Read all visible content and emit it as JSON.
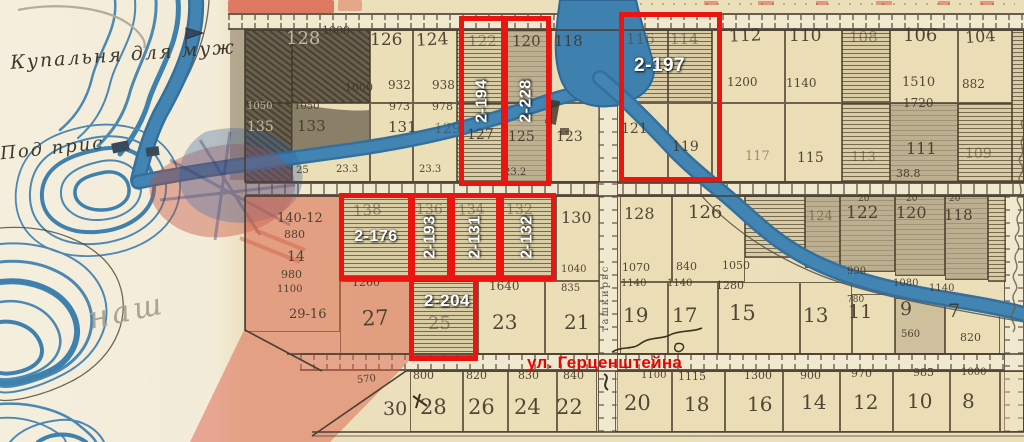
{
  "colors": {
    "paper": "#f0e7cd",
    "grid_ink": "#4a4034",
    "water": "#3f81ae",
    "water_deep": "#2c6693",
    "wash_red": "#d95f4a",
    "annotation_red": "#ea1410",
    "label_white": "#ffffff",
    "street_red": "#e30505",
    "pencil": "#aba393",
    "dark_plot": "#6a604d"
  },
  "annotations": {
    "street_label": "ул. Герценштейна",
    "boxes": [
      {
        "id": "2-194",
        "x": 459,
        "y": 16,
        "w": 47,
        "h": 170,
        "style": "vert"
      },
      {
        "id": "2-228",
        "x": 503,
        "y": 16,
        "w": 48,
        "h": 170,
        "style": "vert"
      },
      {
        "id": "2-197",
        "x": 619,
        "y": 12,
        "w": 103,
        "h": 170,
        "style": "corner"
      },
      {
        "id": "2-176",
        "x": 339,
        "y": 193,
        "w": 74,
        "h": 88,
        "style": "mid"
      },
      {
        "id": "2-193",
        "x": 410,
        "y": 193,
        "w": 42,
        "h": 88,
        "style": "vert"
      },
      {
        "id": "2-131",
        "x": 450,
        "y": 193,
        "w": 51,
        "h": 88,
        "style": "vert"
      },
      {
        "id": "2-132",
        "x": 499,
        "y": 193,
        "w": 57,
        "h": 88,
        "style": "vert"
      },
      {
        "id": "2-204",
        "x": 409,
        "y": 276,
        "w": 69,
        "h": 85,
        "style": "top"
      }
    ]
  },
  "handwriting": {
    "note_bath": "Купальня для муж",
    "note_pier": "Под прис",
    "pencil_note": "наш",
    "street_vertical": "ташкирвс"
  },
  "map": {
    "cells": [
      [
        245,
        30,
        47,
        73,
        "dark"
      ],
      [
        292,
        30,
        78,
        73,
        "dark"
      ],
      [
        370,
        30,
        43,
        73,
        "plain"
      ],
      [
        413,
        30,
        44,
        73,
        "plain"
      ],
      [
        457,
        30,
        48,
        73,
        "hatch"
      ],
      [
        505,
        30,
        46,
        73,
        "gray"
      ],
      [
        551,
        30,
        49,
        73,
        "plain"
      ],
      [
        245,
        103,
        47,
        79,
        "dark"
      ],
      [
        292,
        103,
        78,
        79,
        "plain"
      ],
      [
        370,
        103,
        43,
        79,
        "plain"
      ],
      [
        413,
        103,
        44,
        79,
        "plain"
      ],
      [
        457,
        103,
        48,
        79,
        "hatch"
      ],
      [
        505,
        103,
        46,
        79,
        "gray"
      ],
      [
        551,
        103,
        49,
        79,
        "plain"
      ],
      [
        620,
        30,
        48,
        73,
        "hatch"
      ],
      [
        668,
        30,
        44,
        73,
        "hatch"
      ],
      [
        712,
        30,
        73,
        73,
        "plain"
      ],
      [
        785,
        30,
        57,
        73,
        "plain"
      ],
      [
        842,
        30,
        48,
        73,
        "hatch"
      ],
      [
        890,
        30,
        68,
        73,
        "plain"
      ],
      [
        958,
        30,
        54,
        73,
        "plain"
      ],
      [
        1012,
        30,
        12,
        152,
        "hatch"
      ],
      [
        620,
        103,
        48,
        79,
        "plain"
      ],
      [
        668,
        103,
        44,
        79,
        "plain"
      ],
      [
        712,
        103,
        73,
        79,
        "plain"
      ],
      [
        785,
        103,
        57,
        79,
        "plain"
      ],
      [
        842,
        103,
        48,
        79,
        "hatch"
      ],
      [
        890,
        103,
        68,
        79,
        "gray"
      ],
      [
        958,
        103,
        54,
        79,
        "hatch"
      ],
      [
        245,
        196,
        95,
        136,
        "plain"
      ],
      [
        340,
        196,
        72,
        85,
        "hatch"
      ],
      [
        412,
        196,
        40,
        85,
        "hatch"
      ],
      [
        452,
        196,
        51,
        85,
        "hatch"
      ],
      [
        503,
        196,
        53,
        85,
        "hatch"
      ],
      [
        556,
        196,
        44,
        85,
        "plain"
      ],
      [
        340,
        281,
        72,
        73,
        "plain"
      ],
      [
        412,
        281,
        66,
        80,
        "hatch"
      ],
      [
        478,
        281,
        67,
        73,
        "plain"
      ],
      [
        545,
        281,
        55,
        73,
        "plain"
      ],
      [
        620,
        196,
        52,
        86,
        "plain"
      ],
      [
        672,
        196,
        73,
        86,
        "plain"
      ],
      [
        745,
        196,
        60,
        62,
        "hatch"
      ],
      [
        805,
        196,
        35,
        72,
        "gray"
      ],
      [
        840,
        196,
        55,
        76,
        "gray"
      ],
      [
        895,
        196,
        50,
        80,
        "gray"
      ],
      [
        945,
        196,
        43,
        84,
        "gray"
      ],
      [
        988,
        196,
        18,
        86,
        "hatch"
      ],
      [
        620,
        282,
        48,
        72,
        "plain"
      ],
      [
        668,
        282,
        50,
        72,
        "plain"
      ],
      [
        718,
        282,
        82,
        72,
        "plain"
      ],
      [
        800,
        282,
        52,
        72,
        "plain"
      ],
      [
        852,
        294,
        43,
        60,
        "plain"
      ],
      [
        895,
        298,
        50,
        56,
        "tan"
      ],
      [
        945,
        303,
        55,
        51,
        "plain"
      ],
      [
        410,
        371,
        53,
        61,
        "plain"
      ],
      [
        463,
        371,
        45,
        61,
        "plain"
      ],
      [
        508,
        371,
        49,
        61,
        "plain"
      ],
      [
        557,
        371,
        40,
        61,
        "plain"
      ],
      [
        615,
        371,
        57,
        61,
        "plain"
      ],
      [
        672,
        371,
        53,
        61,
        "plain"
      ],
      [
        725,
        371,
        58,
        61,
        "plain"
      ],
      [
        783,
        371,
        57,
        61,
        "plain"
      ],
      [
        840,
        371,
        53,
        61,
        "plain"
      ],
      [
        893,
        371,
        57,
        61,
        "plain"
      ],
      [
        950,
        371,
        50,
        61,
        "plain"
      ],
      [
        1000,
        371,
        24,
        61,
        "plain"
      ]
    ],
    "texts": [
      [
        "1000",
        322,
        25,
        11,
        0,
        ""
      ],
      [
        "128",
        286,
        30,
        18,
        0,
        "ondark"
      ],
      [
        "126",
        370,
        32,
        17,
        0,
        ""
      ],
      [
        "124",
        416,
        32,
        17,
        -3,
        ""
      ],
      [
        "122",
        468,
        34,
        15,
        0,
        "faint"
      ],
      [
        "120",
        512,
        34,
        15,
        0,
        ""
      ],
      [
        "118",
        554,
        34,
        15,
        0,
        ""
      ],
      [
        "1000",
        345,
        82,
        11,
        0,
        ""
      ],
      [
        "932",
        388,
        79,
        12,
        0,
        ""
      ],
      [
        "938",
        432,
        79,
        12,
        0,
        ""
      ],
      [
        "1050",
        247,
        102,
        10,
        0,
        "ondark"
      ],
      [
        "1050",
        294,
        102,
        10,
        0,
        ""
      ],
      [
        "973",
        389,
        101,
        11,
        0,
        ""
      ],
      [
        "978",
        432,
        101,
        11,
        0,
        ""
      ],
      [
        "135",
        247,
        120,
        14,
        0,
        "ondark"
      ],
      [
        "133",
        297,
        119,
        15,
        0,
        ""
      ],
      [
        "131",
        388,
        120,
        15,
        0,
        ""
      ],
      [
        "129",
        434,
        122,
        14,
        0,
        "faint"
      ],
      [
        "127",
        467,
        128,
        14,
        0,
        ""
      ],
      [
        "125",
        508,
        130,
        14,
        0,
        ""
      ],
      [
        "123",
        556,
        130,
        14,
        0,
        ""
      ],
      [
        "25",
        296,
        166,
        10,
        0,
        ""
      ],
      [
        "23.3",
        336,
        165,
        10,
        0,
        ""
      ],
      [
        "23.3",
        419,
        165,
        10,
        0,
        ""
      ],
      [
        "23.2",
        504,
        168,
        10,
        0,
        ""
      ],
      [
        "116",
        626,
        32,
        15,
        0,
        "faint"
      ],
      [
        "114",
        670,
        32,
        15,
        0,
        "faint"
      ],
      [
        "112",
        729,
        28,
        17,
        -2,
        ""
      ],
      [
        "110",
        789,
        28,
        17,
        0,
        ""
      ],
      [
        "108",
        849,
        30,
        15,
        0,
        "faint"
      ],
      [
        "106",
        903,
        27,
        18,
        0,
        ""
      ],
      [
        "104",
        965,
        29,
        16,
        -4,
        ""
      ],
      [
        "1200",
        727,
        76,
        12,
        0,
        ""
      ],
      [
        "1140",
        786,
        77,
        12,
        0,
        ""
      ],
      [
        "1510",
        902,
        76,
        13,
        0,
        ""
      ],
      [
        "882",
        962,
        78,
        12,
        0,
        ""
      ],
      [
        "1720",
        903,
        97,
        12,
        0,
        ""
      ],
      [
        "121",
        621,
        122,
        14,
        0,
        ""
      ],
      [
        "119",
        672,
        140,
        14,
        0,
        ""
      ],
      [
        "117",
        745,
        150,
        13,
        0,
        "faint"
      ],
      [
        "115",
        797,
        151,
        14,
        0,
        ""
      ],
      [
        "113",
        851,
        151,
        13,
        0,
        "faint"
      ],
      [
        "111",
        906,
        141,
        16,
        0,
        ""
      ],
      [
        "38.8",
        896,
        168,
        11,
        0,
        ""
      ],
      [
        "109",
        965,
        147,
        14,
        0,
        "faint"
      ],
      [
        "140-12",
        277,
        212,
        13,
        0,
        ""
      ],
      [
        "880",
        284,
        229,
        11,
        0,
        ""
      ],
      [
        "14",
        287,
        250,
        14,
        0,
        ""
      ],
      [
        "980",
        281,
        269,
        11,
        0,
        ""
      ],
      [
        "1100",
        277,
        285,
        10,
        0,
        ""
      ],
      [
        "29-16",
        289,
        308,
        13,
        0,
        ""
      ],
      [
        "138",
        353,
        203,
        15,
        -4,
        "faint"
      ],
      [
        "136",
        416,
        203,
        14,
        0,
        "faint"
      ],
      [
        "134",
        458,
        203,
        14,
        -3,
        "faint"
      ],
      [
        "132",
        506,
        203,
        14,
        0,
        "faint"
      ],
      [
        "130",
        561,
        210,
        16,
        0,
        ""
      ],
      [
        "1260",
        352,
        277,
        11,
        0,
        ""
      ],
      [
        "1640",
        489,
        280,
        12,
        0,
        ""
      ],
      [
        "1040",
        561,
        265,
        10,
        0,
        ""
      ],
      [
        "835",
        561,
        284,
        10,
        0,
        ""
      ],
      [
        "27",
        362,
        308,
        21,
        -3,
        ""
      ],
      [
        "25",
        428,
        315,
        18,
        0,
        "faint"
      ],
      [
        "23",
        492,
        312,
        20,
        0,
        ""
      ],
      [
        "21",
        564,
        312,
        20,
        0,
        ""
      ],
      [
        "128",
        624,
        206,
        16,
        0,
        ""
      ],
      [
        "126",
        688,
        204,
        18,
        0,
        ""
      ],
      [
        "124",
        808,
        210,
        13,
        0,
        "faint"
      ],
      [
        "122",
        846,
        205,
        17,
        0,
        ""
      ],
      [
        "120",
        896,
        205,
        16,
        0,
        ""
      ],
      [
        "118",
        944,
        208,
        15,
        0,
        ""
      ],
      [
        "20",
        858,
        195,
        9,
        0,
        ""
      ],
      [
        "20",
        906,
        195,
        9,
        0,
        ""
      ],
      [
        "20",
        949,
        195,
        9,
        0,
        ""
      ],
      [
        "1070",
        622,
        262,
        11,
        0,
        ""
      ],
      [
        "840",
        676,
        261,
        11,
        0,
        ""
      ],
      [
        "1050",
        722,
        260,
        11,
        0,
        ""
      ],
      [
        "1140",
        621,
        279,
        10,
        0,
        ""
      ],
      [
        "1140",
        667,
        279,
        10,
        0,
        ""
      ],
      [
        "1280",
        716,
        280,
        11,
        0,
        ""
      ],
      [
        "990",
        847,
        267,
        10,
        0,
        ""
      ],
      [
        "1080",
        893,
        279,
        10,
        0,
        ""
      ],
      [
        "1140",
        929,
        284,
        10,
        0,
        ""
      ],
      [
        "780",
        847,
        296,
        9,
        0,
        ""
      ],
      [
        "19",
        623,
        305,
        20,
        0,
        ""
      ],
      [
        "17",
        672,
        305,
        20,
        0,
        ""
      ],
      [
        "15",
        729,
        303,
        21,
        0,
        ""
      ],
      [
        "13",
        803,
        305,
        20,
        0,
        ""
      ],
      [
        "11",
        848,
        303,
        19,
        0,
        ""
      ],
      [
        "9",
        900,
        300,
        19,
        0,
        ""
      ],
      [
        "560",
        901,
        330,
        10,
        0,
        ""
      ],
      [
        "7",
        948,
        302,
        19,
        0,
        ""
      ],
      [
        "820",
        960,
        332,
        11,
        0,
        ""
      ],
      [
        "570",
        357,
        375,
        10,
        -6,
        ""
      ],
      [
        "800",
        413,
        370,
        11,
        0,
        ""
      ],
      [
        "820",
        466,
        370,
        11,
        0,
        ""
      ],
      [
        "830",
        518,
        370,
        11,
        0,
        ""
      ],
      [
        "840",
        563,
        370,
        11,
        0,
        ""
      ],
      [
        "1100",
        641,
        371,
        10,
        0,
        ""
      ],
      [
        "1115",
        678,
        371,
        11,
        0,
        ""
      ],
      [
        "1300",
        744,
        370,
        11,
        0,
        ""
      ],
      [
        "900",
        800,
        370,
        11,
        0,
        ""
      ],
      [
        "970",
        851,
        368,
        11,
        0,
        ""
      ],
      [
        "985",
        913,
        367,
        11,
        0,
        ""
      ],
      [
        "1000",
        961,
        368,
        10,
        0,
        ""
      ],
      [
        "30",
        383,
        400,
        19,
        0,
        ""
      ],
      [
        "28",
        420,
        397,
        21,
        0,
        ""
      ],
      [
        "26",
        468,
        397,
        21,
        0,
        ""
      ],
      [
        "24",
        514,
        397,
        21,
        0,
        ""
      ],
      [
        "22",
        556,
        397,
        21,
        0,
        ""
      ],
      [
        "20",
        624,
        393,
        21,
        0,
        ""
      ],
      [
        "18",
        684,
        394,
        20,
        0,
        ""
      ],
      [
        "16",
        747,
        394,
        20,
        0,
        ""
      ],
      [
        "14",
        801,
        392,
        20,
        0,
        ""
      ],
      [
        "12",
        853,
        392,
        20,
        0,
        ""
      ],
      [
        "10",
        907,
        391,
        20,
        0,
        ""
      ],
      [
        "8",
        962,
        391,
        20,
        0,
        ""
      ]
    ]
  }
}
